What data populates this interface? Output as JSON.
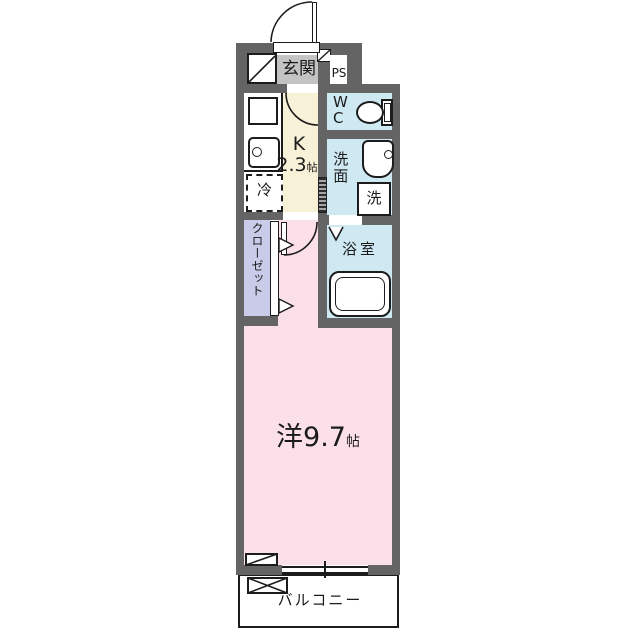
{
  "colors": {
    "bg": "#ffffff",
    "wall": "#646464",
    "line": "#1c1c1c",
    "ink": "#1b1b1b",
    "genkan": "#c3c3c3",
    "kitchen": "#f7f1d7",
    "water": "#cfe9f3",
    "closet": "#c9cbe8",
    "room": "#fbdfe9"
  },
  "labels": {
    "genkan": "玄関",
    "ps": "PS",
    "wc": "W\nC",
    "kitchen": "K",
    "kitchen_size": "2.3",
    "kitchen_unit": "帖",
    "fridge": "冷",
    "senmen": "洗面",
    "laundry": "洗",
    "bath": "浴室",
    "closet": "クローゼット",
    "room": "洋9.7",
    "room_unit": "帖",
    "balcony": "バルコニー"
  },
  "icons": {
    "toilet-icon": "css-shape: tank rectangle + oval bowl",
    "washbasin-icon": "css-shape: rounded square + faucet dot",
    "bathtub-icon": "css-shape: nested rounded rectangles",
    "kitchen-sink-icon": "css-shape: rounded rectangle + faucet circle",
    "stove-counter-icon": "css-shape: bordered square",
    "fridge-icon": "css-shape: dashed square",
    "door-swing-arc-icon": "svg quarter arc",
    "folding-door-icon": "svg V mark",
    "sliding-door-icon": "hatched strip",
    "closet-door-triangle-icon": "svg right-pointing triangles",
    "window-icon": "double line with center tick",
    "crossed-box-icon": "rectangle with X diagonals",
    "diagonal-box-icon": "rectangle with single diagonal"
  }
}
